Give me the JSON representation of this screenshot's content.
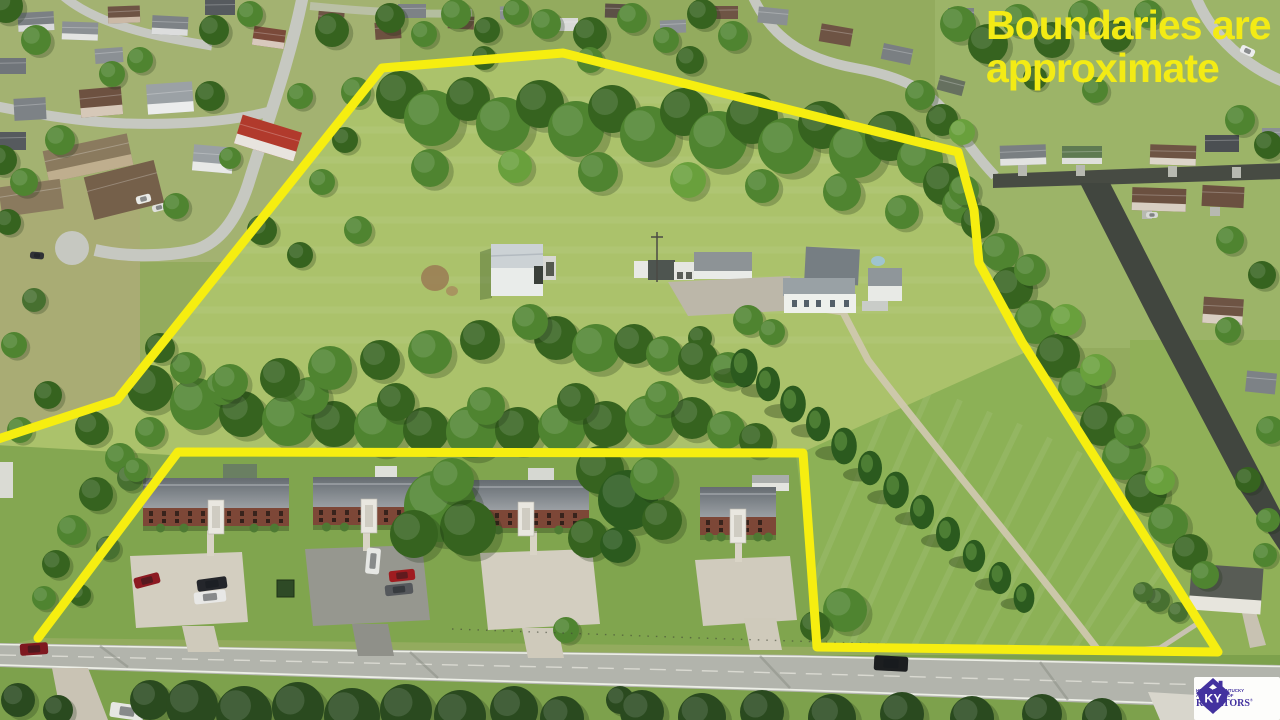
{
  "overlay": {
    "disclaimer_line1": "Boundaries are",
    "disclaimer_line2": "approximate",
    "disclaimer_color": "#f3eb15"
  },
  "branding": {
    "monogram": "KY",
    "org_line1": "HEART OF KENTUCKY",
    "org_line2": "ASSOCIATION OF",
    "org_line3": "REALTORS",
    "registered_mark": "®",
    "brand_color": "#43329f"
  },
  "scene": {
    "boundary_color": "#f6ee10"
  }
}
